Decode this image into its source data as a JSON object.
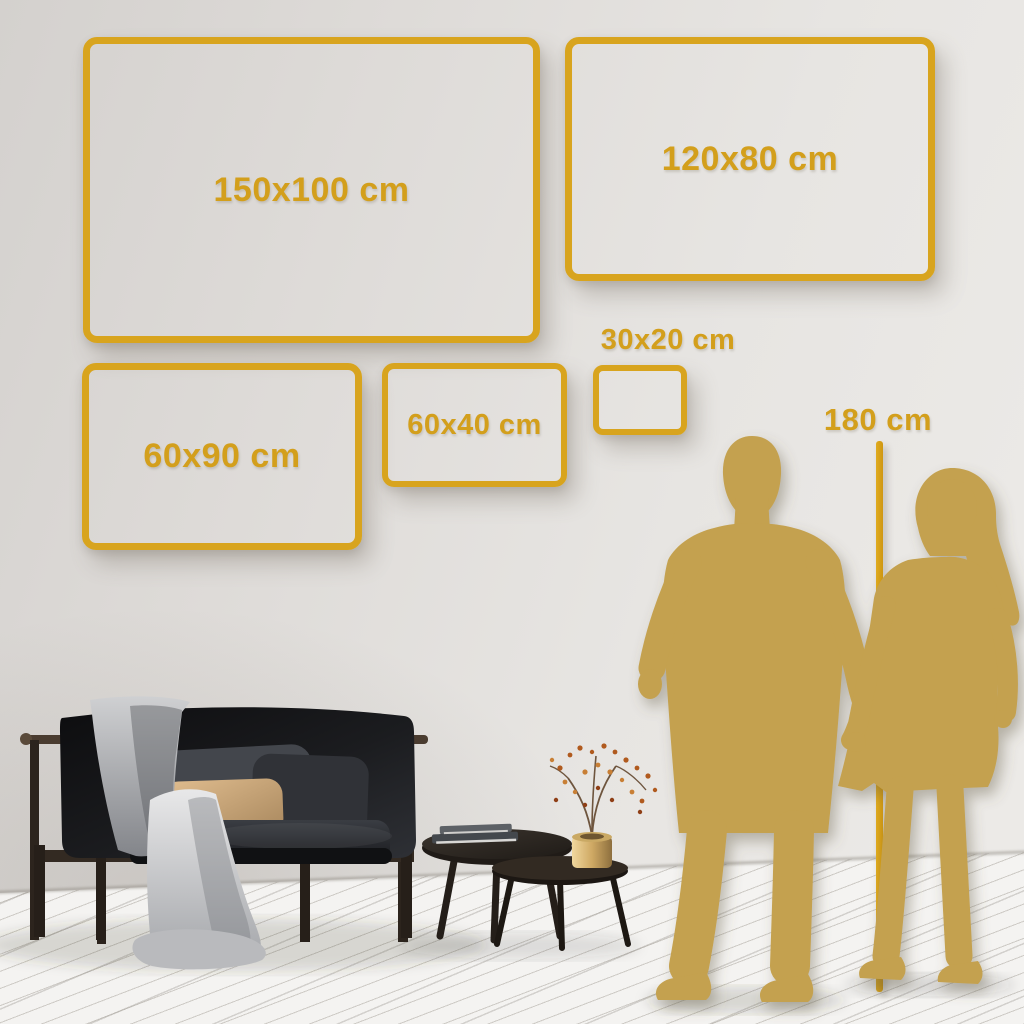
{
  "colors": {
    "gold_frame": "#d8a41e",
    "gold_text": "#d39f1c",
    "silhouette_gold": "#c4a14f",
    "wall": "#e2dfdc",
    "floor": "#f4f3f1"
  },
  "size_frames": [
    {
      "label": "150x100 cm",
      "width_cm": 150,
      "height_cm": 100
    },
    {
      "label": "120x80 cm",
      "width_cm": 120,
      "height_cm": 80
    },
    {
      "label": "60x90 cm",
      "width_cm": 60,
      "height_cm": 90
    },
    {
      "label": "60x40 cm",
      "width_cm": 60,
      "height_cm": 40
    },
    {
      "label": "30x20 cm",
      "width_cm": 30,
      "height_cm": 20
    }
  ],
  "height_reference": {
    "label": "180 cm",
    "height_cm": 180
  },
  "scene_objects": [
    "dark-velvet-sofa-with-gray-blanket",
    "tan-pillow",
    "nesting-coffee-tables-with-books",
    "brass-vase-with-dried-branch",
    "man-silhouette",
    "woman-silhouette",
    "white-wood-plank-floor"
  ]
}
